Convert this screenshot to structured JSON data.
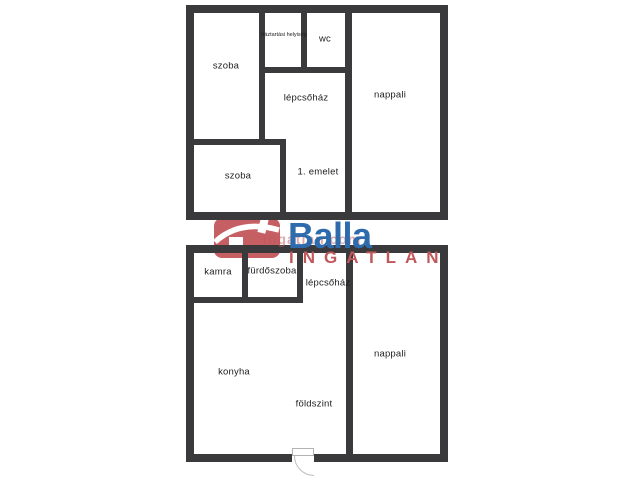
{
  "floors": {
    "upper": {
      "level_label": "1. emelet",
      "rooms": {
        "szoba1": "szoba",
        "haztartasi": "háztartási helyiség",
        "wc": "wc",
        "lepcsohaz": "lépcsőház",
        "nappali": "nappali",
        "szoba2": "szoba"
      }
    },
    "ground": {
      "level_label": "földszint",
      "rooms": {
        "kamra": "kamra",
        "furdoszoba": "fürdőszoba",
        "lepcsohaz": "lépcsőház",
        "konyha": "konyha",
        "nappali": "nappali"
      }
    }
  },
  "logo": {
    "brand": "Balla",
    "subtitle": "INGATLAN",
    "watermark": "ingatlan.com"
  },
  "colors": {
    "wall": "#3a3a3c",
    "logo_blue": "#2e6bad",
    "logo_red": "#c0575b",
    "icon_red": "#c65f63",
    "background": "#ffffff"
  }
}
